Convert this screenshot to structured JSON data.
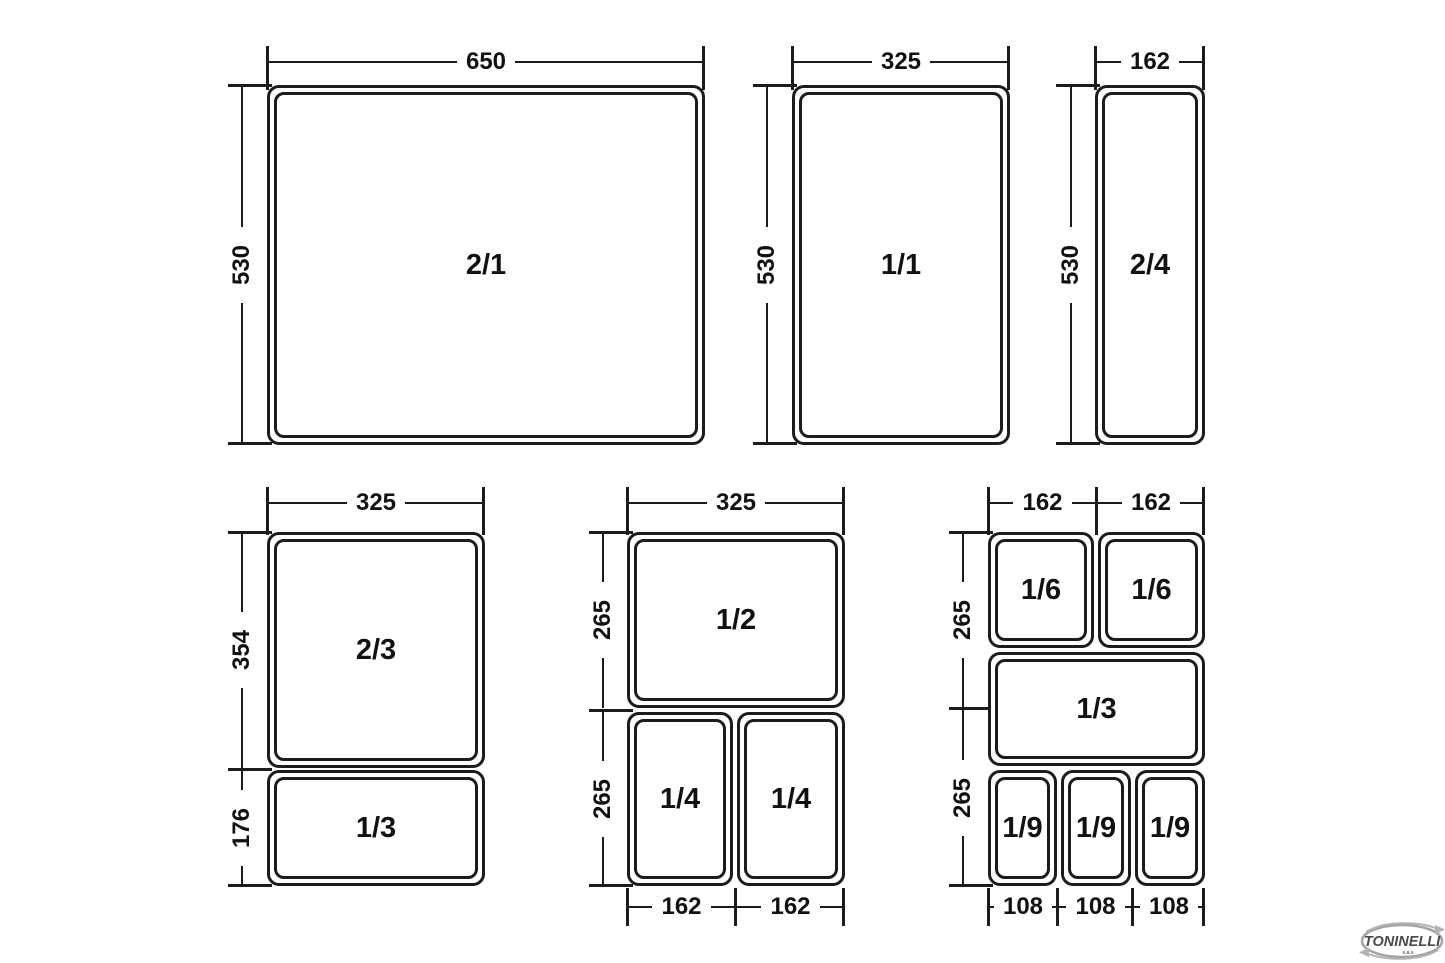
{
  "groups": {
    "gn21": {
      "pan": "2/1",
      "top_dim": "650",
      "side_dim": "530"
    },
    "gn11": {
      "pan": "1/1",
      "top_dim": "325",
      "side_dim": "530"
    },
    "gn24": {
      "pan": "2/4",
      "top_dim": "162",
      "side_dim": "530"
    },
    "gn23": {
      "top_dim": "325",
      "pan_top": "2/3",
      "pan_bottom": "1/3",
      "side_dim_top": "354",
      "side_dim_bottom": "176"
    },
    "gn12": {
      "top_dim": "325",
      "pan_top": "1/2",
      "pan_bottom_left": "1/4",
      "pan_bottom_right": "1/4",
      "side_dim_top": "265",
      "side_dim_bottom": "265",
      "bottom_dim_left": "162",
      "bottom_dim_right": "162"
    },
    "gn16": {
      "top_dim_left": "162",
      "top_dim_right": "162",
      "pan_top_left": "1/6",
      "pan_top_right": "1/6",
      "pan_middle": "1/3",
      "pan_bottom_1": "1/9",
      "pan_bottom_2": "1/9",
      "pan_bottom_3": "1/9",
      "side_dim_top": "265",
      "side_dim_bottom": "265",
      "bottom_dim_1": "108",
      "bottom_dim_2": "108",
      "bottom_dim_3": "108"
    }
  },
  "logo": {
    "brand": "TONINELLI",
    "suffix": "s.a.s"
  }
}
